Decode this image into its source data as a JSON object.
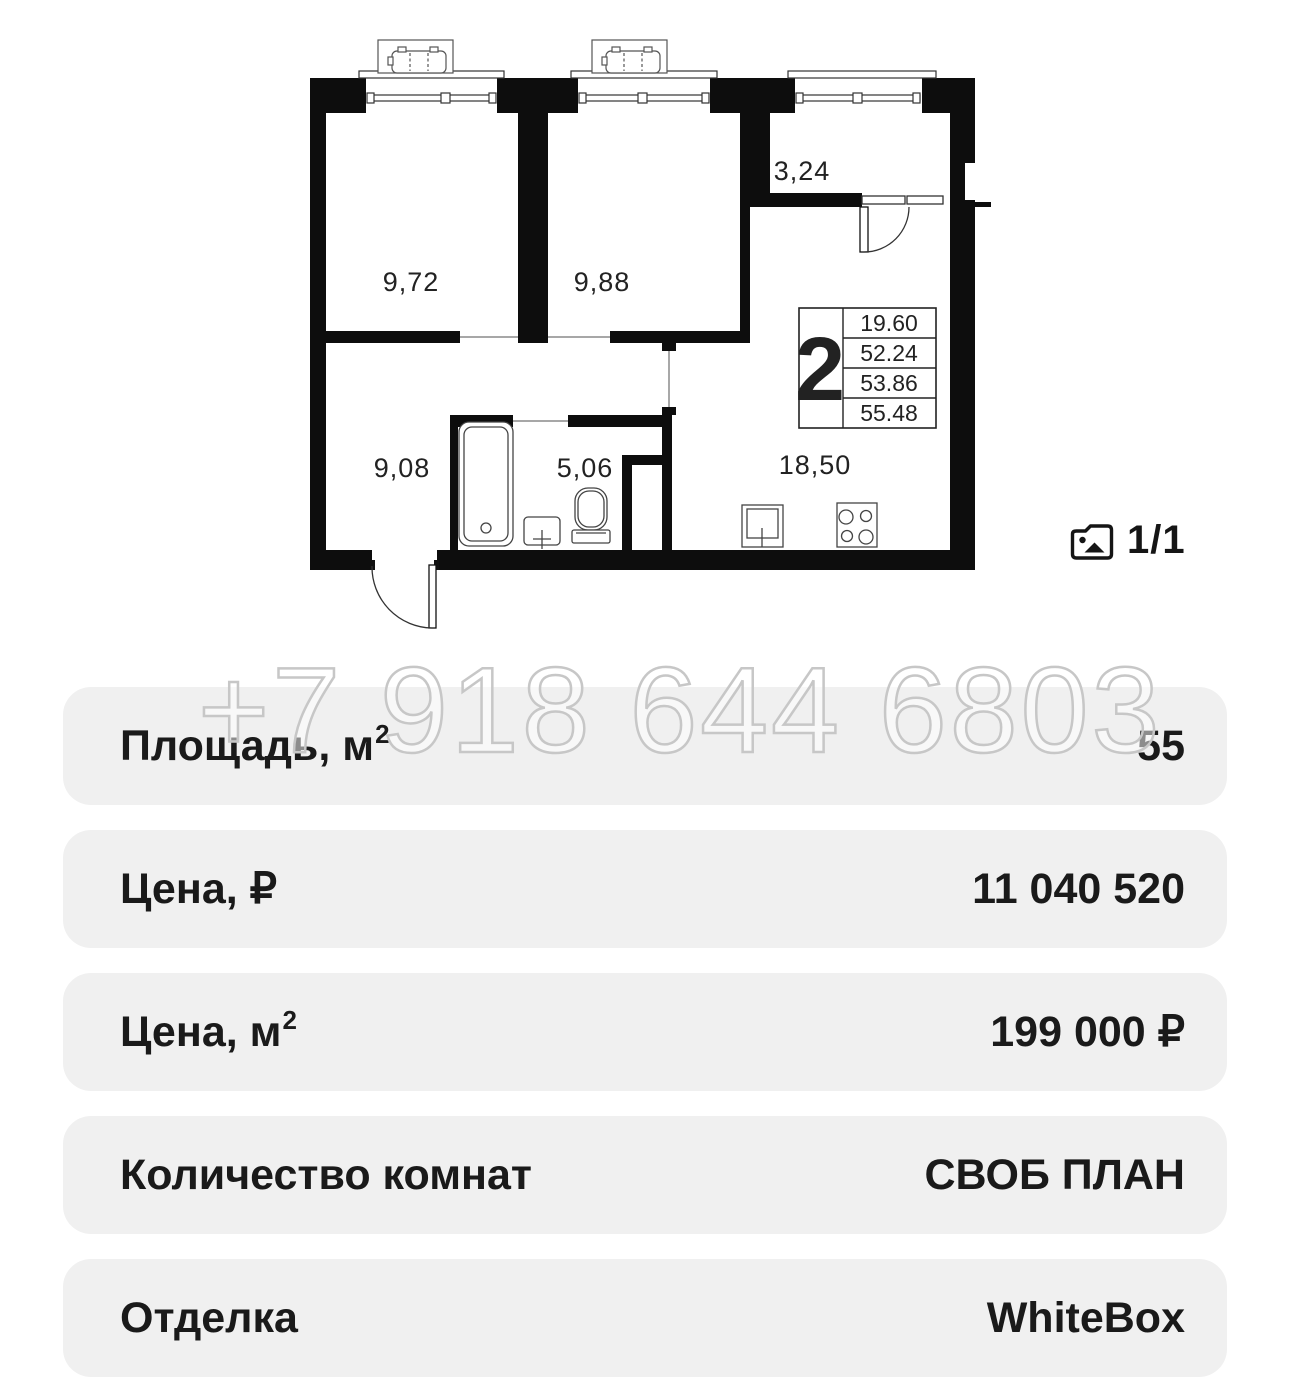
{
  "floor_plan": {
    "rooms": [
      {
        "name": "room-1",
        "area": "9,72"
      },
      {
        "name": "room-2",
        "area": "9,88"
      },
      {
        "name": "balcony",
        "area": "3,24"
      },
      {
        "name": "hallway",
        "area": "9,08"
      },
      {
        "name": "bathroom",
        "area": "5,06"
      },
      {
        "name": "kitchen-living",
        "area": "18,50"
      }
    ],
    "legend": {
      "rooms_count": "2",
      "areas": [
        "19.60",
        "52.24",
        "53.86",
        "55.48"
      ]
    },
    "gallery": {
      "counter": "1/1",
      "icon": "photo-folder-icon"
    }
  },
  "watermark": {
    "text": "+7 918 644 6803"
  },
  "details": {
    "rows": [
      {
        "label": "Площадь, м",
        "sup": "2",
        "value": "55"
      },
      {
        "label": "Цена, ₽",
        "sup": "",
        "value": "11 040 520"
      },
      {
        "label": "Цена, м",
        "sup": "2",
        "value": "199 000 ₽"
      },
      {
        "label": "Количество комнат",
        "sup": "",
        "value": "СВОБ ПЛАН"
      },
      {
        "label": "Отделка",
        "sup": "",
        "value": "WhiteBox"
      }
    ]
  },
  "colors": {
    "wall": "#0d0d0d",
    "row_background": "#f0f0f0",
    "text": "#1a1a1a",
    "watermark_stroke": "#c7c7c7"
  }
}
